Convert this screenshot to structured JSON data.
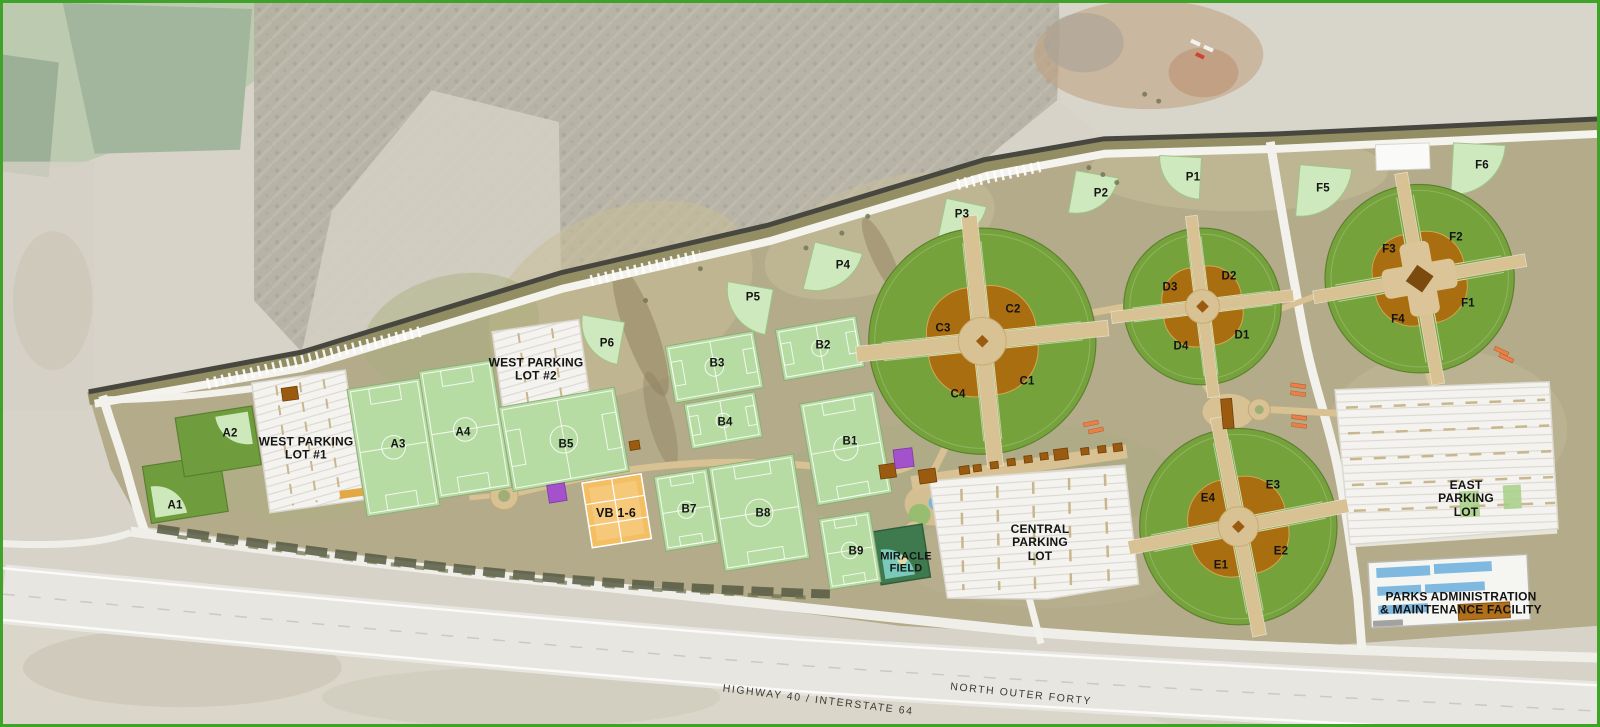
{
  "map_labels": {
    "fields": {
      "a1": "A1",
      "a2": "A2",
      "a3": "A3",
      "a4": "A4",
      "b1": "B1",
      "b2": "B2",
      "b3": "B3",
      "b4": "B4",
      "b5": "B5",
      "b7": "B7",
      "b8": "B8",
      "b9": "B9",
      "c1": "C1",
      "c2": "C2",
      "c3": "C3",
      "c4": "C4",
      "d1": "D1",
      "d2": "D2",
      "d3": "D3",
      "d4": "D4",
      "e1": "E1",
      "e2": "E2",
      "e3": "E3",
      "e4": "E4",
      "f1": "F1",
      "f2": "F2",
      "f3": "F3",
      "f4": "F4",
      "f5": "F5",
      "f6": "F6",
      "p1": "P1",
      "p2": "P2",
      "p3": "P3",
      "p4": "P4",
      "p5": "P5",
      "p6": "P6",
      "vb": "VB 1-6"
    },
    "parking": {
      "west1": {
        "line1": "WEST PARKING",
        "line2": "LOT #1"
      },
      "west2": {
        "line1": "WEST PARKING",
        "line2": "LOT #2"
      },
      "central": {
        "line1": "CENTRAL",
        "line2": "PARKING",
        "line3": "LOT"
      },
      "east": {
        "line1": "EAST",
        "line2": "PARKING",
        "line3": "LOT"
      }
    },
    "facilities": {
      "miracle": {
        "line1": "MIRACLE",
        "line2": "FIELD"
      },
      "admin": {
        "line1": "PARKS ADMINISTRATION",
        "line2": "& MAINTENANCE FACILITY"
      }
    },
    "roads": {
      "highway": "HIGHWAY 40 / INTERSTATE 64",
      "outer_forty": "NORTH OUTER FORTY"
    }
  },
  "colors": {
    "frame_green": "#3FA32A",
    "outfield_green": "#76A23C",
    "soccer_green": "#B6DCA3",
    "practice_green": "#CFE9BF",
    "infield_brown": "#A96E0F",
    "infield_edge": "#D2A855",
    "path_tan": "#D8C193",
    "volleyball_orange": "#F4BE63",
    "court_purple": "#A352CC",
    "bleacher_orange": "#E8804A",
    "building_brown": "#9A5B10",
    "parking_white": "#F4F3F0",
    "admin_roof_blue": "#7FB9E0",
    "miracle_green": "#3F7A4E",
    "miracle_teal": "#7CCFC0"
  }
}
